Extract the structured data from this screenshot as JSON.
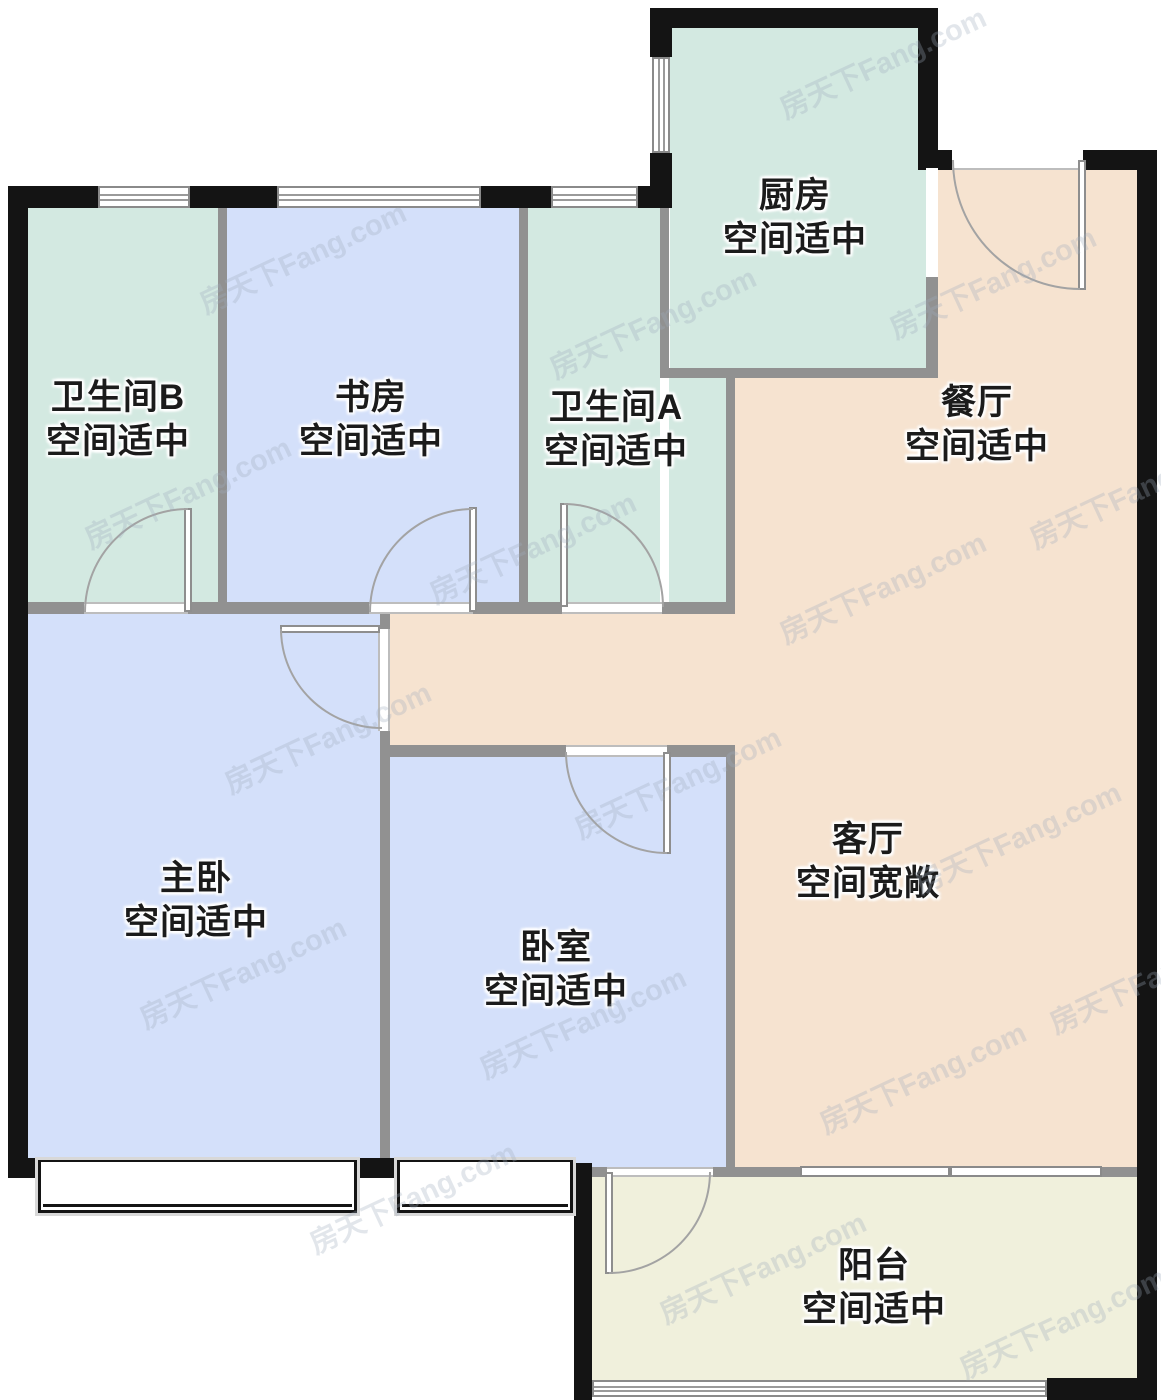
{
  "watermark": {
    "text": "房天下Fang.com"
  },
  "colors": {
    "wall": "#141414",
    "partition": "#919191",
    "mint": "#d3e9e1",
    "blue": "#d4e0fa",
    "peach": "#f6e3d0",
    "balcony_fill": "#f0f0dc",
    "label_text": "#1b1b1b"
  },
  "rooms": [
    {
      "name": "厨房",
      "note": "空间适中"
    },
    {
      "name": "卫生间B",
      "note": "空间适中"
    },
    {
      "name": "书房",
      "note": "空间适中"
    },
    {
      "name": "卫生间A",
      "note": "空间适中"
    },
    {
      "name": "餐厅",
      "note": "空间适中"
    },
    {
      "name": "主卧",
      "note": "空间适中"
    },
    {
      "name": "卧室",
      "note": "空间适中"
    },
    {
      "name": "客厅",
      "note": "空间宽敞"
    },
    {
      "name": "阳台",
      "note": "空间适中"
    }
  ]
}
